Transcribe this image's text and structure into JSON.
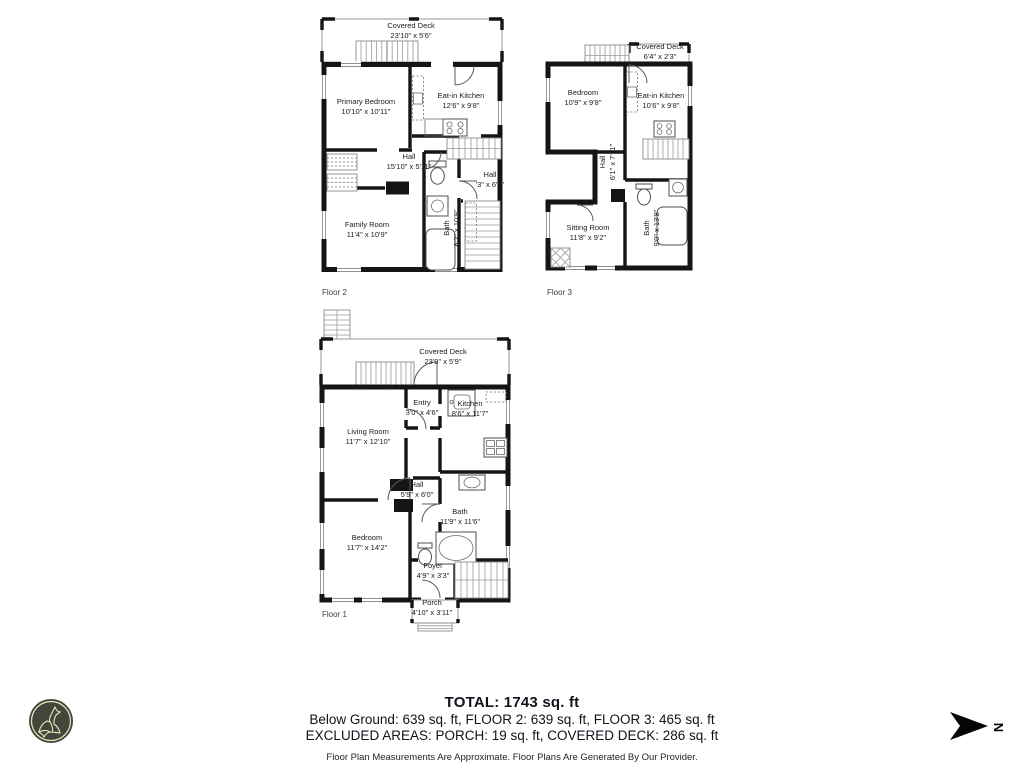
{
  "plans": [
    {
      "floor_tag": "Floor 2",
      "rooms": [
        {
          "name": "Covered Deck",
          "dims": "23'10\" x 5'6\""
        },
        {
          "name": "Primary Bedroom",
          "dims": "10'10\" x 10'11\""
        },
        {
          "name": "Eat-in Kitchen",
          "dims": "12'6\" x 9'8\""
        },
        {
          "name": "Hall",
          "dims": "15'10\" x 5'11\""
        },
        {
          "name": "Hall",
          "dims": "'3\" x 6'2\""
        },
        {
          "name": "Family Room",
          "dims": "11'4\" x 10'9\""
        },
        {
          "name": "Bath",
          "dims": "6'2\" x 10'9\""
        }
      ]
    },
    {
      "floor_tag": "Floor 3",
      "rooms": [
        {
          "name": "Covered Deck",
          "dims": "6'4\" x 2'3\""
        },
        {
          "name": "Bedroom",
          "dims": "10'9\" x 9'8\""
        },
        {
          "name": "Eat-in Kitchen",
          "dims": "10'6\" x 9'8\""
        },
        {
          "name": "Hall",
          "dims": "6'1\" x 7'11\""
        },
        {
          "name": "Sitting Room",
          "dims": "11'8\" x 9'2\""
        },
        {
          "name": "Bath",
          "dims": "9'0\" x 13'8\""
        }
      ]
    },
    {
      "floor_tag": "Floor 1",
      "rooms": [
        {
          "name": "Covered Deck",
          "dims": "23'9\" x 5'9\""
        },
        {
          "name": "Entry",
          "dims": "3'0\" x 4'6\""
        },
        {
          "name": "Kitchen",
          "dims": "8'6\" x 11'7\""
        },
        {
          "name": "Living Room",
          "dims": "11'7\" x 12'10\""
        },
        {
          "name": "Hall",
          "dims": "5'9\" x 6'0\""
        },
        {
          "name": "Bath",
          "dims": "11'9\" x 11'6\""
        },
        {
          "name": "Bedroom",
          "dims": "11'7\" x 14'2\""
        },
        {
          "name": "Foyer",
          "dims": "4'9\" x 3'3\""
        },
        {
          "name": "Porch",
          "dims": "4'10\" x 3'11\""
        }
      ]
    }
  ],
  "summary": {
    "total": "TOTAL: 1743 sq. ft",
    "line1": "Below Ground: 639 sq. ft, FLOOR 2: 639 sq. ft, FLOOR 3: 465 sq. ft",
    "line2": "EXCLUDED AREAS: PORCH: 19 sq. ft, COVERED DECK: 286 sq. ft",
    "disclaimer": "Floor Plan Measurements Are Approximate. Floor Plans Are Generated By Our Provider."
  },
  "compass": {
    "label": "N"
  },
  "icons": {
    "logo": "wolf-logo",
    "compass": "north-arrow"
  },
  "colors": {
    "wall": "#151515",
    "logo_circle": "#45453c",
    "logo_art": "#e7ebbd"
  }
}
